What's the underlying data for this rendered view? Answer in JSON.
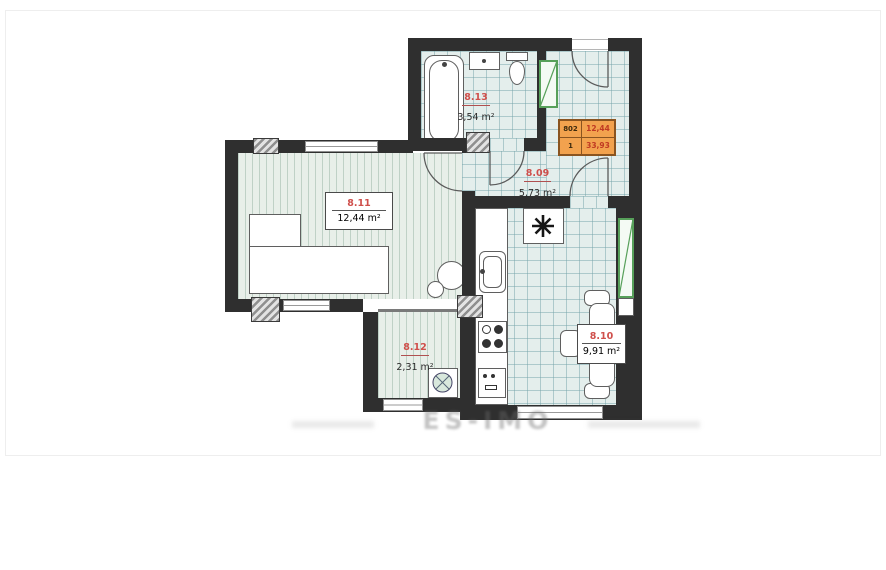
{
  "watermark": "ES-IMO",
  "unit_info": {
    "number": "802",
    "rooms": "1",
    "living_area": "12,44",
    "total_area": "33,93"
  },
  "rooms": [
    {
      "id": "8.11",
      "area": "12,44 m²",
      "type": "living-room"
    },
    {
      "id": "8.13",
      "area": "3,54 m²",
      "type": "bathroom"
    },
    {
      "id": "8.09",
      "area": "5,73 m²",
      "type": "hallway"
    },
    {
      "id": "8.12",
      "area": "2,31 m²",
      "type": "closet"
    },
    {
      "id": "8.10",
      "area": "9,91 m²",
      "type": "kitchen"
    }
  ],
  "colors": {
    "wall": "#2f2f2f",
    "accent_red": "#cf4f4b",
    "badge_bg": "#f2a24e",
    "badge_border": "#8a5420",
    "shaft_green": "#57a05a",
    "floor_tile": "#e4eeec",
    "floor_stripe": "#e8efe9"
  }
}
